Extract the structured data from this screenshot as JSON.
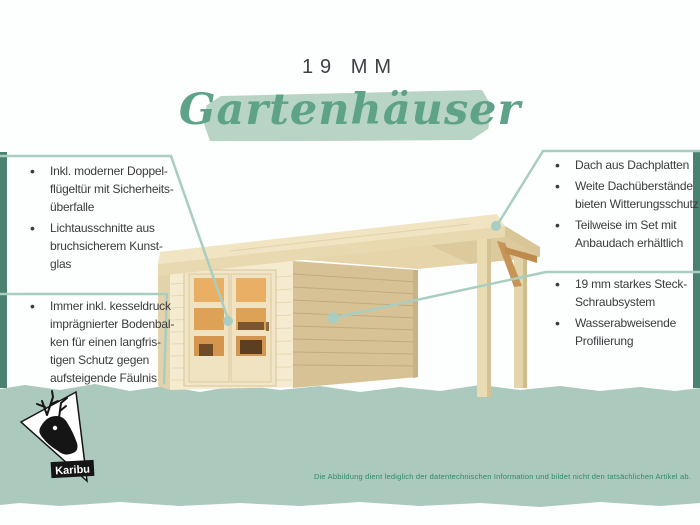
{
  "header": {
    "title_top": "19 MM",
    "title_script": "Gartenhäuser"
  },
  "callouts": {
    "left_top": {
      "items": [
        "Inkl. moderner Doppel-\nflügeltür mit Sicherheits-\nüberfalle",
        "Lichtausschnitte aus\nbruchsicherem Kunst-\nglas"
      ]
    },
    "left_bottom": {
      "items": [
        "Immer inkl. kesseldruck\nimprägnierter Bodenbal-\nken für einen langfris-\ntigen Schutz gegen\naufsteigende Fäulnis"
      ]
    },
    "right_top": {
      "items": [
        "Dach aus Dachplatten",
        "Weite Dachüberstände\nbieten Witterungsschutz",
        "Teilweise im Set mit\nAnbaudach erhältlich"
      ]
    },
    "right_bottom": {
      "items": [
        "19 mm starkes Steck-\nSchraubsystem",
        "Wasserabweisende\nProfilierung"
      ]
    }
  },
  "footer": {
    "disclaimer": "Die Abbildung dient lediglich der datentechnischen Information und bildet nicht den tatsächlichen Artikel ab.",
    "brand": "Karibu"
  },
  "icons": {
    "logo": "deer-icon"
  },
  "colors": {
    "edge_stripe_green": "#4a8171",
    "footer_band_green": "#abc9bc",
    "highlight_band_green": "#b7d4c5",
    "script_title_green": "#5ea287",
    "callout_line_green": "#a8cec1",
    "disclaimer_green": "#2f8a6c",
    "body_text": "#3b3b3d",
    "wood_light": "#f5ebd0",
    "wood_roof": "#f0e4c2",
    "wood_side_wall": "#d7c295",
    "window_amber": "#e4a95e"
  }
}
